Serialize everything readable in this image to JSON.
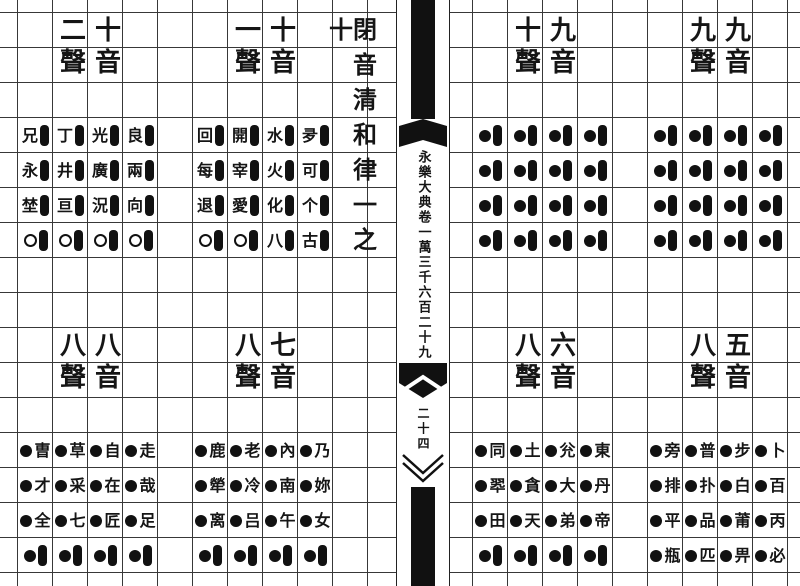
{
  "paper": {
    "background": "#ffffff",
    "ink": "#151515",
    "grid_line": "#383838"
  },
  "spine": {
    "title": "永樂大典卷一萬三千六百二十九",
    "page_number": "二十四"
  },
  "left_page": {
    "section_title": "閉音清和律一之十"
  },
  "groups": [
    {
      "id": "top-left",
      "header": {
        "yin": "十音",
        "sheng": "二聲"
      },
      "rows": [
        [
          {
            "type": "char-bar",
            "char": "兄"
          },
          {
            "type": "char-bar",
            "char": "丁"
          },
          {
            "type": "char-bar",
            "char": "光"
          },
          {
            "type": "char-bar",
            "char": "良"
          }
        ],
        [
          {
            "type": "char-bar",
            "char": "永"
          },
          {
            "type": "char-bar",
            "char": "井"
          },
          {
            "type": "char-bar",
            "char": "廣"
          },
          {
            "type": "char-bar",
            "char": "兩"
          }
        ],
        [
          {
            "type": "char-bar",
            "char": "埜"
          },
          {
            "type": "char-bar",
            "char": "亘"
          },
          {
            "type": "char-bar",
            "char": "況"
          },
          {
            "type": "char-bar",
            "char": "向"
          }
        ],
        [
          {
            "type": "circle-bar"
          },
          {
            "type": "circle-bar"
          },
          {
            "type": "circle-bar"
          },
          {
            "type": "circle-bar"
          }
        ]
      ]
    },
    {
      "id": "top-middle",
      "header": {
        "yin": "十音",
        "sheng": "一聲"
      },
      "rows": [
        [
          {
            "type": "char-bar",
            "char": "回"
          },
          {
            "type": "char-bar",
            "char": "開"
          },
          {
            "type": "char-bar",
            "char": "水"
          },
          {
            "type": "char-bar",
            "char": "夛"
          }
        ],
        [
          {
            "type": "char-bar",
            "char": "每"
          },
          {
            "type": "char-bar",
            "char": "宰"
          },
          {
            "type": "char-bar",
            "char": "火"
          },
          {
            "type": "char-bar",
            "char": "可"
          }
        ],
        [
          {
            "type": "char-bar",
            "char": "退"
          },
          {
            "type": "char-bar",
            "char": "愛"
          },
          {
            "type": "char-bar",
            "char": "化"
          },
          {
            "type": "char-bar",
            "char": "个"
          }
        ],
        [
          {
            "type": "circle-bar"
          },
          {
            "type": "circle-bar"
          },
          {
            "type": "char-bar",
            "char": "八"
          },
          {
            "type": "char-bar",
            "char": "古"
          }
        ]
      ]
    },
    {
      "id": "top-right",
      "header": {
        "yin": "九音",
        "sheng": "十聲"
      },
      "rows": [
        [
          {
            "type": "dot-bar"
          },
          {
            "type": "dot-bar"
          },
          {
            "type": "dot-bar"
          },
          {
            "type": "dot-bar"
          }
        ],
        [
          {
            "type": "dot-bar"
          },
          {
            "type": "dot-bar"
          },
          {
            "type": "dot-bar"
          },
          {
            "type": "dot-bar"
          }
        ],
        [
          {
            "type": "dot-bar"
          },
          {
            "type": "dot-bar"
          },
          {
            "type": "dot-bar"
          },
          {
            "type": "dot-bar"
          }
        ],
        [
          {
            "type": "dot-bar"
          },
          {
            "type": "dot-bar"
          },
          {
            "type": "dot-bar"
          },
          {
            "type": "dot-bar"
          }
        ]
      ]
    },
    {
      "id": "top-far-right",
      "header": {
        "yin": "九音",
        "sheng": "九聲"
      },
      "rows": [
        [
          {
            "type": "dot-bar"
          },
          {
            "type": "dot-bar"
          },
          {
            "type": "dot-bar"
          },
          {
            "type": "dot-bar"
          }
        ],
        [
          {
            "type": "dot-bar"
          },
          {
            "type": "dot-bar"
          },
          {
            "type": "dot-bar"
          },
          {
            "type": "dot-bar"
          }
        ],
        [
          {
            "type": "dot-bar"
          },
          {
            "type": "dot-bar"
          },
          {
            "type": "dot-bar"
          },
          {
            "type": "dot-bar"
          }
        ],
        [
          {
            "type": "dot-bar"
          },
          {
            "type": "dot-bar"
          },
          {
            "type": "dot-bar"
          },
          {
            "type": "dot-bar"
          }
        ]
      ]
    },
    {
      "id": "bottom-left",
      "header": {
        "yin": "八音",
        "sheng": "八聲"
      },
      "rows": [
        [
          {
            "type": "dot-char",
            "char": "曺"
          },
          {
            "type": "dot-char",
            "char": "草"
          },
          {
            "type": "dot-char",
            "char": "自"
          },
          {
            "type": "dot-char",
            "char": "走"
          }
        ],
        [
          {
            "type": "dot-char",
            "char": "才"
          },
          {
            "type": "dot-char",
            "char": "采"
          },
          {
            "type": "dot-char",
            "char": "在"
          },
          {
            "type": "dot-char",
            "char": "哉"
          }
        ],
        [
          {
            "type": "dot-char",
            "char": "全"
          },
          {
            "type": "dot-char",
            "char": "七"
          },
          {
            "type": "dot-char",
            "char": "匠"
          },
          {
            "type": "dot-char",
            "char": "足"
          }
        ],
        [
          {
            "type": "dot-bar"
          },
          {
            "type": "dot-bar"
          },
          {
            "type": "dot-bar"
          },
          {
            "type": "dot-bar"
          }
        ]
      ]
    },
    {
      "id": "bottom-middle",
      "header": {
        "yin": "七音",
        "sheng": "八聲"
      },
      "rows": [
        [
          {
            "type": "dot-char",
            "char": "鹿"
          },
          {
            "type": "dot-char",
            "char": "老"
          },
          {
            "type": "dot-char",
            "char": "內"
          },
          {
            "type": "dot-char",
            "char": "乃"
          }
        ],
        [
          {
            "type": "dot-char",
            "char": "犖"
          },
          {
            "type": "dot-char",
            "char": "冷"
          },
          {
            "type": "dot-char",
            "char": "南"
          },
          {
            "type": "dot-char",
            "char": "妳"
          }
        ],
        [
          {
            "type": "dot-char",
            "char": "离"
          },
          {
            "type": "dot-char",
            "char": "吕"
          },
          {
            "type": "dot-char",
            "char": "午"
          },
          {
            "type": "dot-char",
            "char": "女"
          }
        ],
        [
          {
            "type": "dot-bar"
          },
          {
            "type": "dot-bar"
          },
          {
            "type": "dot-bar"
          },
          {
            "type": "dot-bar"
          }
        ]
      ]
    },
    {
      "id": "bottom-right",
      "header": {
        "yin": "六音",
        "sheng": "八聲"
      },
      "rows": [
        [
          {
            "type": "dot-char",
            "char": "同"
          },
          {
            "type": "dot-char",
            "char": "土"
          },
          {
            "type": "dot-char",
            "char": "兊"
          },
          {
            "type": "dot-char",
            "char": "東"
          }
        ],
        [
          {
            "type": "dot-char",
            "char": "翆"
          },
          {
            "type": "dot-char",
            "char": "貪"
          },
          {
            "type": "dot-char",
            "char": "大"
          },
          {
            "type": "dot-char",
            "char": "丹"
          }
        ],
        [
          {
            "type": "dot-char",
            "char": "田"
          },
          {
            "type": "dot-char",
            "char": "天"
          },
          {
            "type": "dot-char",
            "char": "弟"
          },
          {
            "type": "dot-char",
            "char": "帝"
          }
        ],
        [
          {
            "type": "dot-bar"
          },
          {
            "type": "dot-bar"
          },
          {
            "type": "dot-bar"
          },
          {
            "type": "dot-bar"
          }
        ]
      ]
    },
    {
      "id": "bottom-far-right",
      "header": {
        "yin": "五音",
        "sheng": "八聲"
      },
      "rows": [
        [
          {
            "type": "dot-char",
            "char": "旁"
          },
          {
            "type": "dot-char",
            "char": "普"
          },
          {
            "type": "dot-char",
            "char": "步"
          },
          {
            "type": "dot-char",
            "char": "卜"
          }
        ],
        [
          {
            "type": "dot-char",
            "char": "排"
          },
          {
            "type": "dot-char",
            "char": "扑"
          },
          {
            "type": "dot-char",
            "char": "白"
          },
          {
            "type": "dot-char",
            "char": "百"
          }
        ],
        [
          {
            "type": "dot-char",
            "char": "平"
          },
          {
            "type": "dot-char",
            "char": "品"
          },
          {
            "type": "dot-char",
            "char": "莆"
          },
          {
            "type": "dot-char",
            "char": "丙"
          }
        ],
        [
          {
            "type": "dot-char",
            "char": "瓶"
          },
          {
            "type": "dot-char",
            "char": "匹"
          },
          {
            "type": "dot-char",
            "char": "畀"
          },
          {
            "type": "dot-char",
            "char": "必"
          }
        ]
      ]
    }
  ]
}
